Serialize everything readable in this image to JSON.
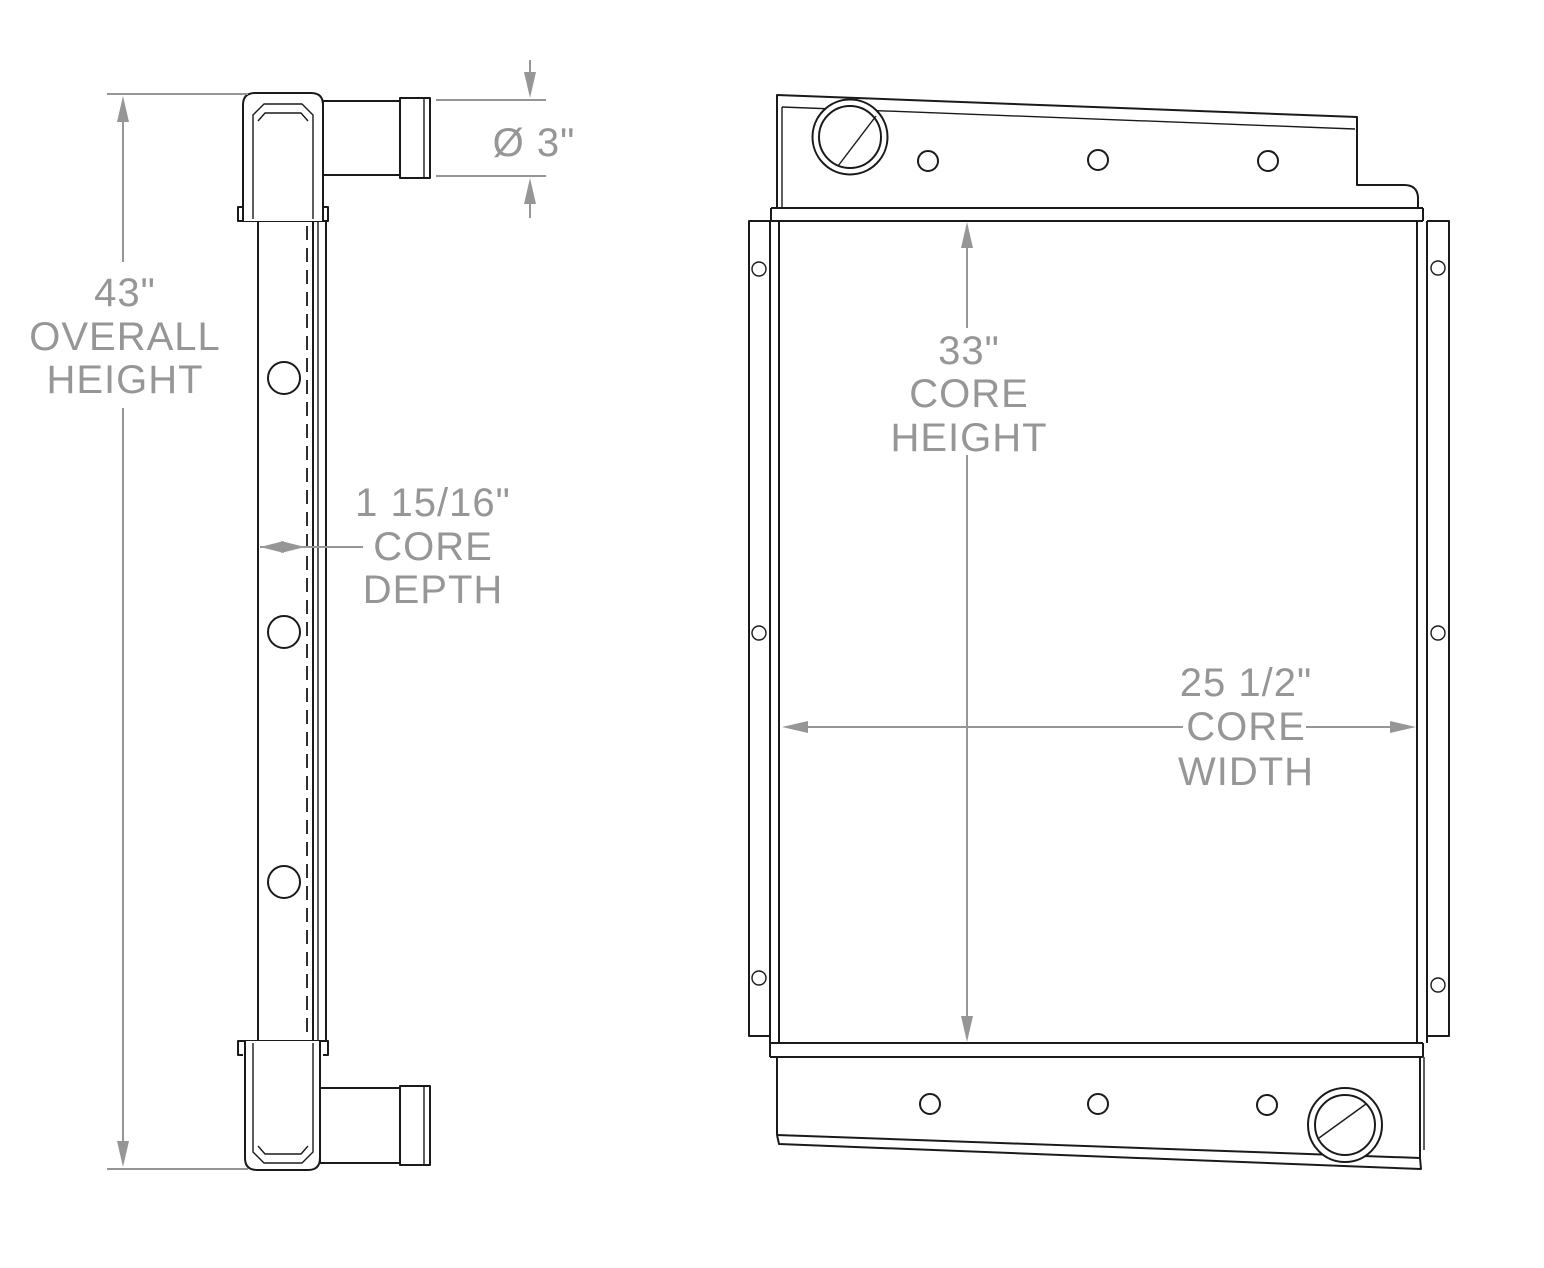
{
  "drawing": {
    "background": "#ffffff",
    "line_color": "#1a1a1a",
    "dimension_color": "#969696",
    "description": "Radiator technical drawing, two orthographic views (side profile and front face)"
  },
  "dimensions": {
    "overall_height": {
      "lines": [
        "43\"",
        "OVERALL",
        "HEIGHT"
      ]
    },
    "pipe_diameter": {
      "lines": [
        "Ø 3\""
      ]
    },
    "core_depth": {
      "lines": [
        "1 15/16\"",
        "CORE",
        "DEPTH"
      ]
    },
    "core_height": {
      "lines": [
        "33\"",
        "CORE",
        "HEIGHT"
      ]
    },
    "core_width": {
      "lines": [
        "25 1/2\"",
        "CORE",
        "WIDTH"
      ]
    }
  }
}
